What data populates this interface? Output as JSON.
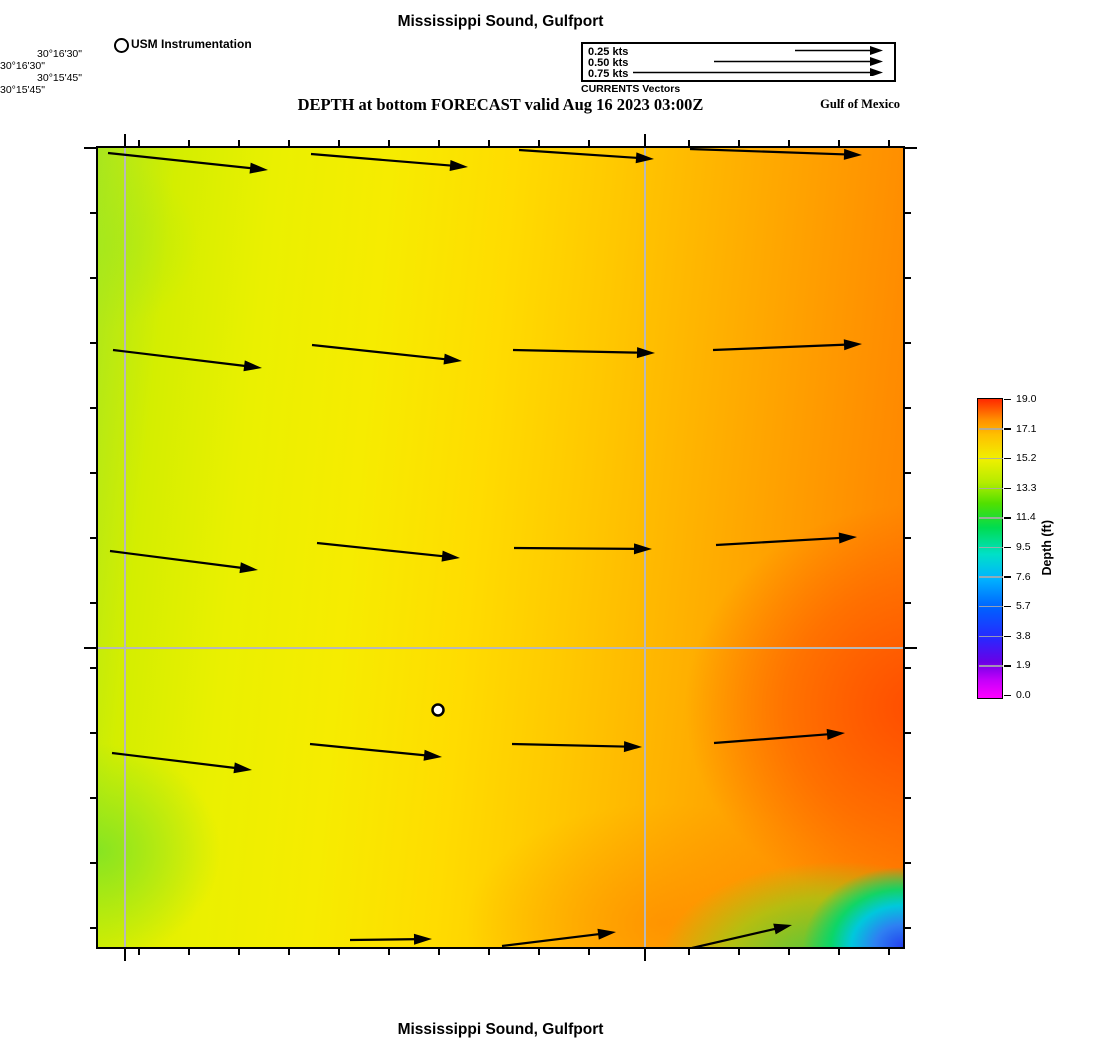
{
  "header": {
    "title": "Mississippi Sound, Gulfport",
    "instrumentation_label": "USM Instrumentation",
    "currents_caption": "CURRENTS Vectors",
    "subtitle": "DEPTH at bottom FORECAST valid Aug 16 2023 03:00Z",
    "region_label": "Gulf of Mexico"
  },
  "footer": {
    "title": "Mississippi Sound, Gulfport"
  },
  "chart_data": {
    "type": "heatmap",
    "title": "Mississippi Sound, Gulfport",
    "subtitle": "DEPTH at bottom FORECAST valid Aug 16 2023 03:00Z",
    "legend_vectors": {
      "caption": "CURRENTS Vectors",
      "entries": [
        {
          "label": "0.25 kts",
          "kts": 0.25,
          "length_px": 88
        },
        {
          "label": "0.50 kts",
          "kts": 0.5,
          "length_px": 169
        },
        {
          "label": "0.75 kts",
          "kts": 0.75,
          "length_px": 250
        }
      ]
    },
    "x_axis": {
      "labels": [
        "−89°05'15\"",
        "−89°04'30\""
      ],
      "label_px": [
        27,
        547
      ],
      "minor_px": [
        41,
        91,
        141,
        191,
        241,
        291,
        341,
        391,
        441,
        491,
        591,
        641,
        691,
        741,
        791
      ]
    },
    "y_axis": {
      "labels": [
        "30°16'30\"",
        "30°15'45\""
      ],
      "label_px": [
        0,
        500
      ],
      "minor_px": [
        65,
        130,
        195,
        260,
        325,
        390,
        455,
        520,
        585,
        650,
        715,
        780
      ]
    },
    "gridlines_px": {
      "vertical": [
        27,
        547
      ],
      "horizontal": [
        500
      ]
    },
    "colorbar": {
      "label": "Depth (ft)",
      "min": 0.0,
      "max": 19.0,
      "ticks": [
        "19.0",
        "17.1",
        "15.2",
        "13.3",
        "11.4",
        "9.5",
        "7.6",
        "5.7",
        "3.8",
        "1.9",
        "0.0"
      ]
    },
    "station_marker": {
      "label": "USM Instrumentation",
      "px": [
        340,
        562
      ]
    },
    "vectors_px": [
      [
        10,
        5,
        170,
        22
      ],
      [
        213,
        6,
        370,
        19
      ],
      [
        421,
        2,
        556,
        11
      ],
      [
        592,
        1,
        764,
        7
      ],
      [
        15,
        202,
        164,
        220
      ],
      [
        214,
        197,
        364,
        213
      ],
      [
        415,
        202,
        557,
        205
      ],
      [
        615,
        202,
        764,
        196
      ],
      [
        12,
        403,
        160,
        422
      ],
      [
        219,
        395,
        362,
        410
      ],
      [
        416,
        400,
        554,
        401
      ],
      [
        618,
        397,
        759,
        389
      ],
      [
        14,
        605,
        154,
        622
      ],
      [
        212,
        596,
        344,
        609
      ],
      [
        414,
        596,
        544,
        599
      ],
      [
        616,
        595,
        747,
        585
      ],
      [
        252,
        792,
        334,
        791
      ],
      [
        404,
        798,
        518,
        784
      ],
      [
        594,
        800,
        694,
        777
      ]
    ],
    "approx_depth_ft_grid": {
      "x_frac": [
        0.1,
        0.3,
        0.5,
        0.7,
        0.9
      ],
      "y_frac": [
        0.1,
        0.3,
        0.5,
        0.7,
        0.9
      ],
      "values": [
        [
          14.7,
          15.3,
          15.8,
          16.4,
          17.0
        ],
        [
          14.5,
          15.2,
          16.0,
          16.8,
          17.5
        ],
        [
          14.4,
          15.3,
          16.2,
          17.1,
          18.1
        ],
        [
          14.2,
          15.4,
          16.3,
          17.3,
          18.6
        ],
        [
          13.9,
          15.3,
          16.5,
          16.8,
          13.5
        ]
      ],
      "notes": "Deepest red area ~18-19 ft along east edge; shallow green-blue patch ~2-6 ft in extreme southeast corner."
    }
  }
}
